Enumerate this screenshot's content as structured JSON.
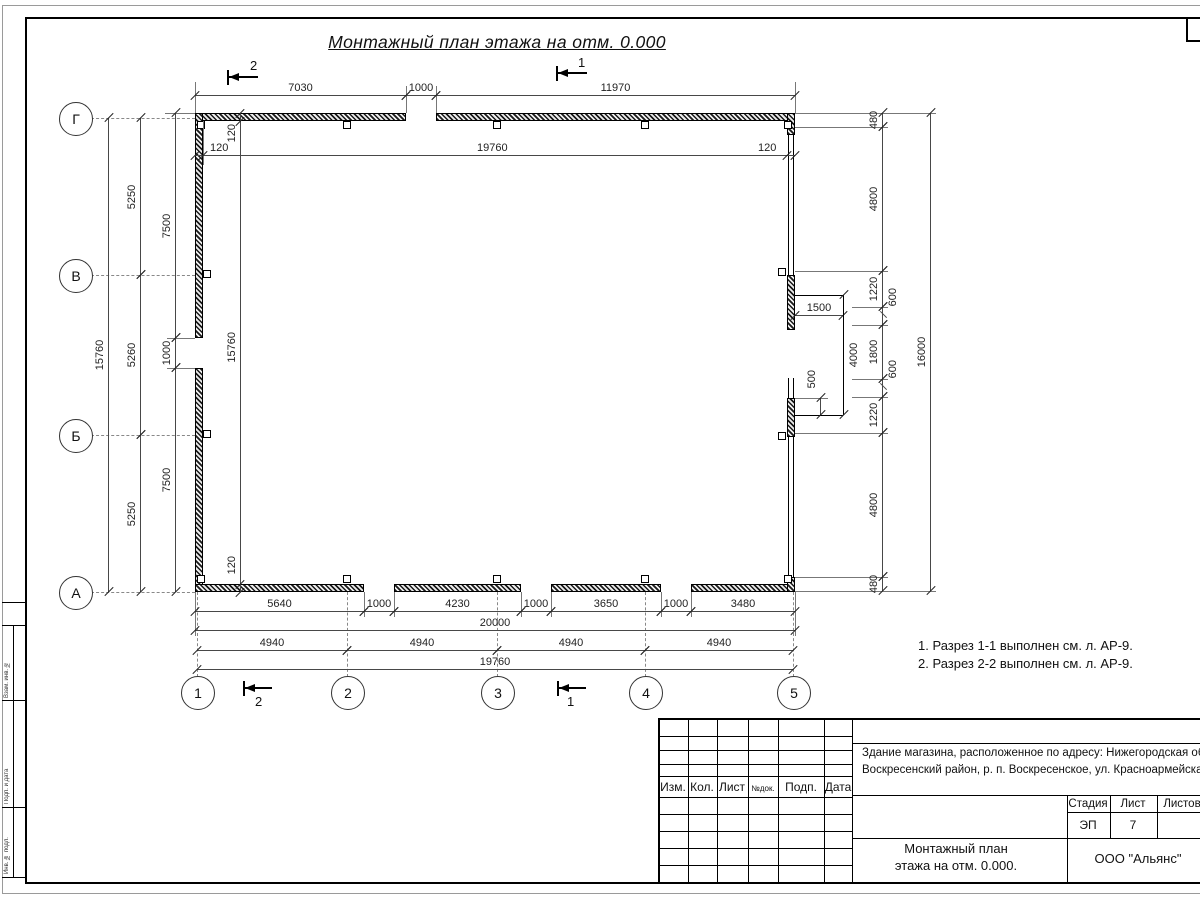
{
  "sheet": {
    "title": "Монтажный план этажа на отм. 0.000",
    "notes": [
      "1. Разрез 1-1 выполнен см. л. АР-9.",
      "2. Разрез 2-2 выполнен см. л. АР-9."
    ]
  },
  "colors": {
    "line": "#1a1a1a",
    "dim_line": "#484848",
    "background": "#ffffff"
  },
  "axes": {
    "horizontal": [
      "Г",
      "В",
      "Б",
      "А"
    ],
    "vertical": [
      "1",
      "2",
      "3",
      "4",
      "5"
    ]
  },
  "section_marks": {
    "top": [
      "2",
      "1"
    ],
    "bottom": [
      "2",
      "1"
    ]
  },
  "dims": {
    "top_chain": [
      "7030",
      "1000",
      "11970"
    ],
    "top_inner": [
      "120",
      "19760",
      "120"
    ],
    "left_total": "15760",
    "left_axis_chain": [
      "5250",
      "5260",
      "5250"
    ],
    "left_wall_chain": [
      "7500",
      "1000",
      "7500"
    ],
    "left_inner": [
      "120",
      "15760",
      "120"
    ],
    "right_chain": [
      "480",
      "4800",
      "1220",
      "600",
      "1800",
      "600",
      "1220",
      "4800",
      "480"
    ],
    "right_total": "16000",
    "recess_width": "1500",
    "recess_height": "4000",
    "recess_offset": "500",
    "bottom_chain": [
      "5640",
      "1000",
      "4230",
      "1000",
      "3650",
      "1000",
      "3480"
    ],
    "bottom_total": "20000",
    "bottom_axis_chain": [
      "4940",
      "4940",
      "4940",
      "4940"
    ],
    "bottom_span": "19760"
  },
  "titleblock": {
    "header_cols": [
      "Изм.",
      "Кол.",
      "Лист",
      "№док.",
      "Подп.",
      "Дата"
    ],
    "project_line1": "Здание магазина, расположенное по адресу: Нижегородская область",
    "project_line2": "Воскресенский район, р. п. Воскресенское, ул. Красноармейская, д. 1",
    "stage_label": "Стадия",
    "sheet_label": "Лист",
    "sheets_label": "Листов",
    "stage_value": "ЭП",
    "sheet_value": "7",
    "doc_title_line1": "Монтажный план",
    "doc_title_line2": "этажа на отм. 0.000.",
    "company": "ООО \"Альянс\""
  },
  "frame_labels": {
    "stamp1": "Взам. инв. №",
    "stamp2": "Подп. и дата",
    "stamp3": "Инв. № подл."
  }
}
